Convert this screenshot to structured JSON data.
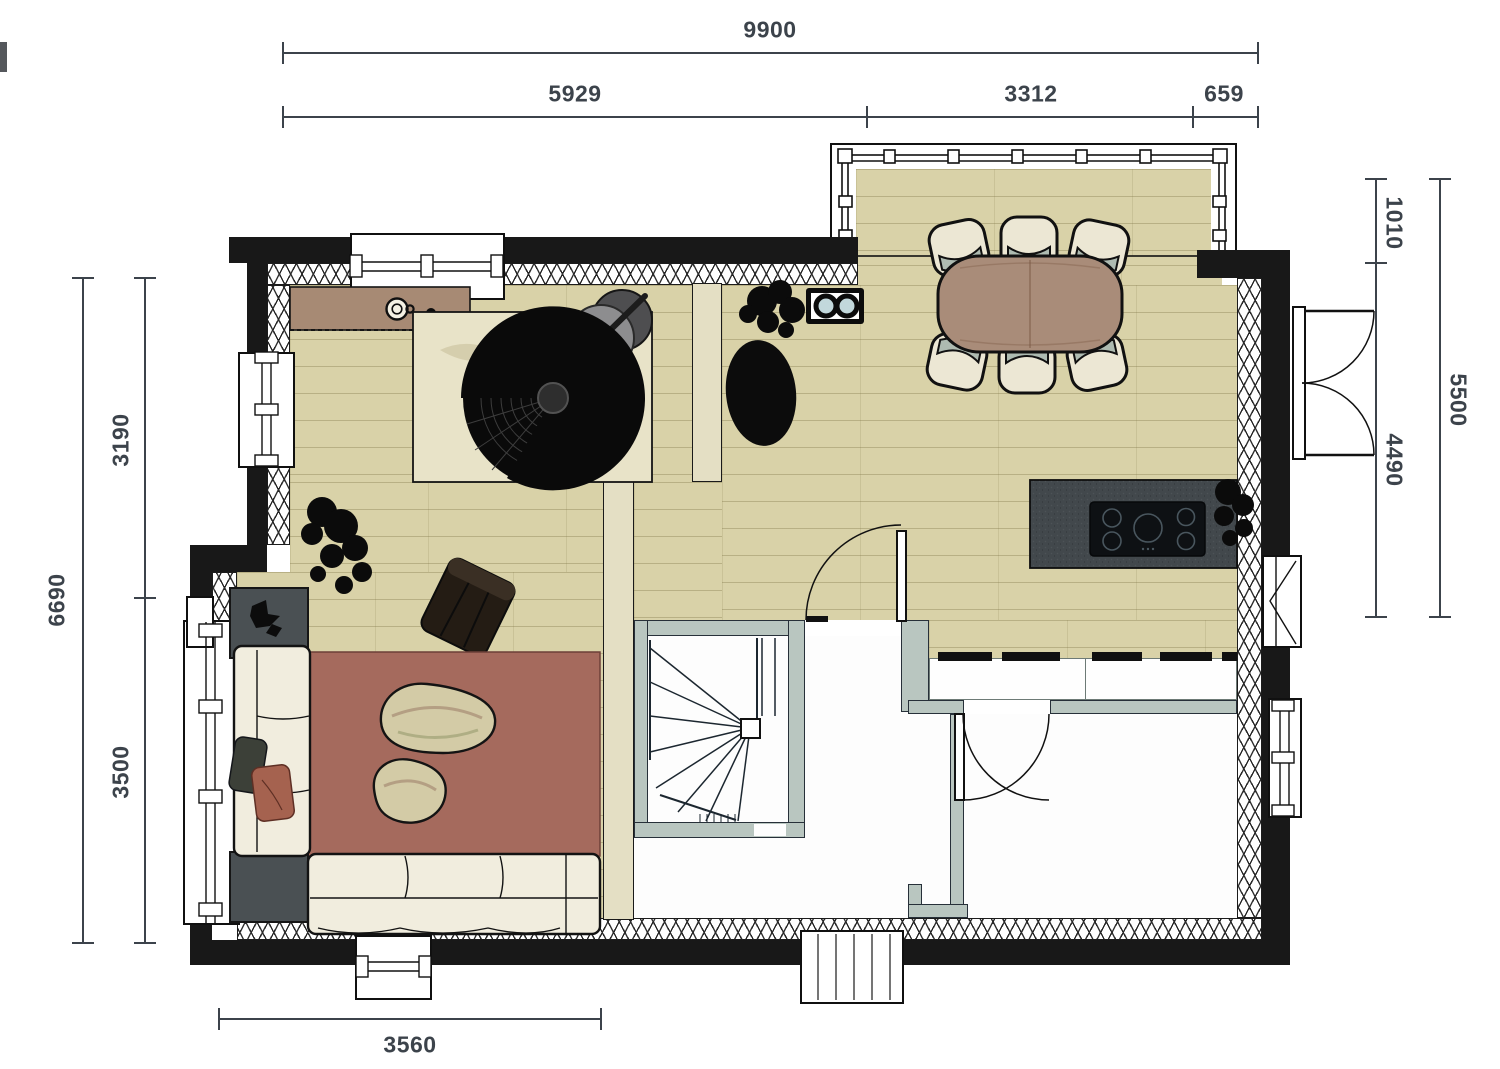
{
  "drawing": {
    "kind": "residential-ground-floor-plan",
    "background": "#ffffff"
  },
  "dims": {
    "top_total": "9900",
    "top_segments": [
      "5929",
      "3312",
      "659"
    ],
    "left_total": "6690",
    "left_segments": [
      "3190",
      "3500"
    ],
    "right_outer": "5500",
    "right_segments": [
      "1010",
      "4490"
    ],
    "bottom_segment": "3560"
  },
  "colors": {
    "wall": "#181818",
    "wood_floor": "#d9d2a8",
    "interior_wall": "#b9c6c0",
    "rug_light": "#e8e3c8",
    "rug_mauve": "#a56a5d",
    "counter": "#42484c",
    "table_wood": "#a98c79",
    "sofa": "#f1edde",
    "side_table_dark": "#4a5053",
    "dimension_text": "#3c434b"
  },
  "icons": [
    "dining-table-icon",
    "dining-chair-icon",
    "kitchen-island-icon",
    "cooktop-icon",
    "wood-stove-icon",
    "round-side-table-icon",
    "corner-sofa-icon",
    "coffee-table-organic-icon",
    "lounge-chair-icon",
    "pouf-icon",
    "plant-icon",
    "coffee-cup-icon",
    "sideboard-icon",
    "winder-staircase-icon",
    "door-swing-icon",
    "french-door-icon",
    "window-icon",
    "entry-steps-icon"
  ]
}
